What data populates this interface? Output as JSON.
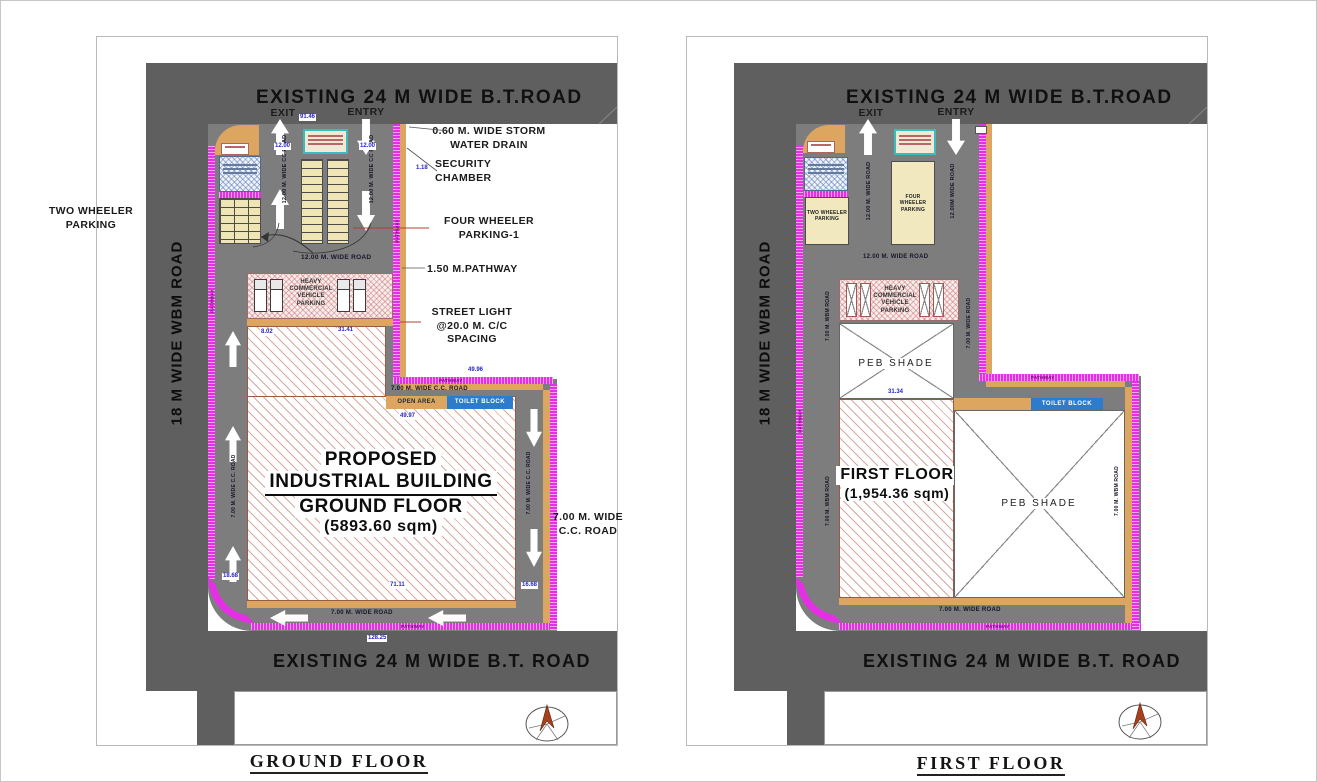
{
  "ground": {
    "title_top": "EXISTING 24 M WIDE B.T.ROAD",
    "title_bottom": "EXISTING 24 M WIDE B.T. ROAD",
    "road_left": "18 M WIDE WBM ROAD",
    "gate_exit": "EXIT",
    "gate_entry": "ENTRY",
    "road_12_h": "12.00 M. WIDE ROAD",
    "road_12_v": "12.00 M. WIDE CC ROAD",
    "road_7cc_h": "7.00 M. WIDE C.C. ROAD",
    "road_7cc_v": "7.00 M. WIDE C.C. ROAD",
    "road_7_bottom": "7.00 M. WIDE ROAD",
    "pathway": "PATHWAY",
    "hcv": "HEAVY COMMERCIAL VEHICLE PARKING",
    "open_area": "OPEN AREA",
    "toilet": "TOILET BLOCK",
    "building": {
      "l1": "PROPOSED",
      "l2": "INDUSTRIAL BUILDING",
      "l3": "GROUND FLOOR",
      "l4": "(5893.60 sqm)"
    },
    "annotations": {
      "two_wheeler": "TWO WHEELER PARKING",
      "storm_drain": "0.60 M. WIDE STORM WATER DRAIN",
      "security": "SECURITY CHAMBER",
      "four_wheeler": "FOUR WHEELER PARKING-1",
      "pathway150": "1.50 M.PATHWAY",
      "street_light": "STREET LIGHT @20.0 M. C/C SPACING",
      "cc_road": "7.00 M. WIDE C.C. ROAD"
    },
    "dims": {
      "d1": "91.46",
      "d2": "1.18",
      "d3": "8.02",
      "d4": "31.41",
      "d5": "49.96",
      "d6": "49.97",
      "d7": "18.68",
      "d8": "71.11",
      "d9": "16.68",
      "d10": "128.25",
      "d12": "12.00"
    },
    "caption": "GROUND FLOOR"
  },
  "first": {
    "title_top": "EXISTING 24 M WIDE B.T.ROAD",
    "title_bottom": "EXISTING 24 M WIDE B.T. ROAD",
    "road_left": "18 M WIDE WBM ROAD",
    "gate_exit": "EXIT",
    "gate_entry": "ENTRY",
    "road_12_h": "12.00 M. WIDE ROAD",
    "road_12_v_left": "12.00 M. WIDE ROAD",
    "road_12_v_right": "12.00M WIDE ROAD",
    "road_7_v_upper": "7.00 M. WIDE ROAD",
    "road_7_wbm": "7.00 M. WBM ROAD",
    "road_7_bottom": "7.00 M. WIDE ROAD",
    "pathway": "PATHWAY",
    "two_wheeler": "TWO WHEELER PARKING",
    "four_wheeler": "FOUR WHEELER PARKING",
    "hcv": "HEAVY COMMERCIAL VEHICLE PARKING",
    "peb": "PEB SHADE",
    "toilet": "TOILET BLOCK",
    "area": {
      "l1": "FIRST FLOOR",
      "l2": "(1,954.36 sqm)"
    },
    "dims": {
      "d1": "31.34"
    },
    "caption": "FIRST FLOOR"
  }
}
